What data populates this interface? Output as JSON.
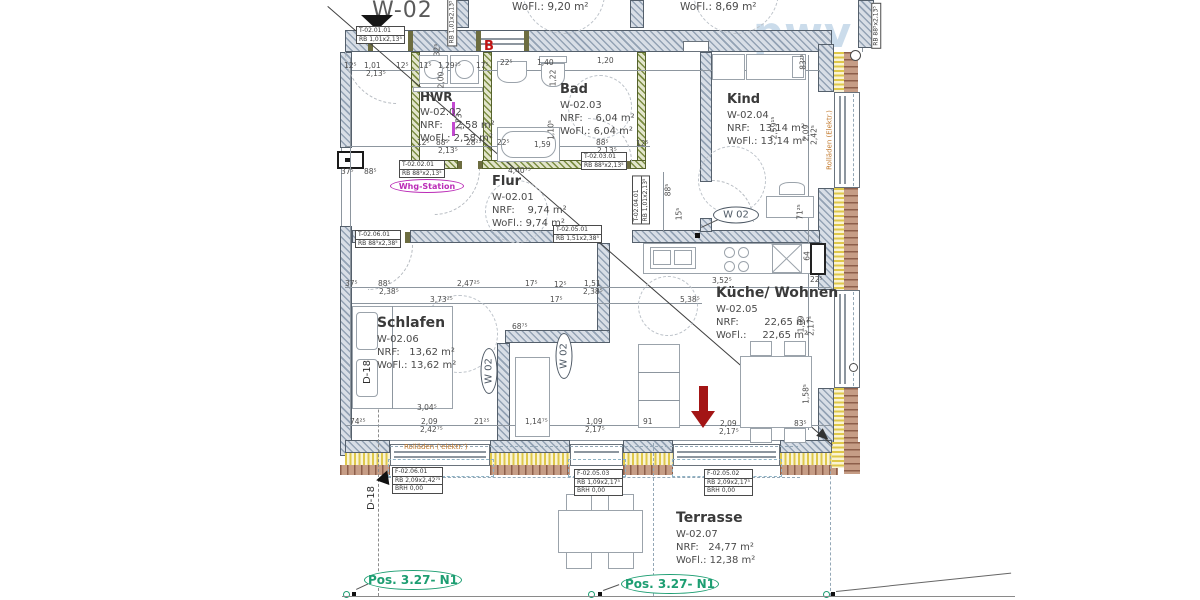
{
  "plan_title": "W-02",
  "watermark": "pwv",
  "colors": {
    "accent_green": "#1d9e72",
    "magenta": "#bb2cb7",
    "orange": "#c27a2e",
    "red_marker": "#a31515",
    "wall_green": "#7b8d42",
    "wall_gray": "#93a2b4",
    "brick": "#8d5f4b",
    "insulation": "#dfc84a",
    "watermark_blue": "#a9c6de"
  },
  "rooms": [
    {
      "title": "HWR",
      "code": "W-02.02",
      "nrf": "NRF:    2,58 m²",
      "wofl": "WoFl.: 2,58 m²",
      "x": 420,
      "y": 90,
      "fs": 12
    },
    {
      "title": "Bad",
      "code": "W-02.03",
      "nrf": "NRF:    6,04 m²",
      "wofl": "WoFl.: 6,04 m²",
      "x": 560,
      "y": 82,
      "fs": 13
    },
    {
      "title": "Kind",
      "code": "W-02.04",
      "nrf": "NRF:   13,14 m²",
      "wofl": "WoFl.: 13,14 m²",
      "x": 727,
      "y": 92,
      "fs": 13
    },
    {
      "title": "Flur",
      "code": "W-02.01",
      "nrf": "NRF:    9,74 m²",
      "wofl": "WoFl.: 9,74 m²",
      "x": 492,
      "y": 174,
      "fs": 13
    },
    {
      "title": "Küche/ Wohnen",
      "code": "W-02.05",
      "nrf": "NRF:        22,65 m²",
      "wofl": "WoFl.:     22,65 m²",
      "x": 716,
      "y": 285,
      "fs": 14
    },
    {
      "title": "Schlafen",
      "code": "W-02.06",
      "nrf": "NRF:   13,62 m²",
      "wofl": "WoFl.: 13,62 m²",
      "x": 377,
      "y": 315,
      "fs": 14
    },
    {
      "title": "Terrasse",
      "code": "W-02.07",
      "nrf": "NRF:   24,77 m²",
      "wofl": "WoFl.: 12,38 m²",
      "x": 676,
      "y": 510,
      "fs": 14
    }
  ],
  "ovals": [
    {
      "t": "W 02",
      "cx": 736,
      "cy": 215,
      "w": 46,
      "h": 17,
      "cls": "gray",
      "fs": 10
    },
    {
      "t": "W 02",
      "cx": 489,
      "cy": 371,
      "w": 46,
      "h": 17,
      "cls": "gray",
      "fs": 10,
      "vert": true
    },
    {
      "t": "W 02",
      "cx": 564,
      "cy": 356,
      "w": 46,
      "h": 17,
      "cls": "gray",
      "fs": 10,
      "vert": true
    },
    {
      "t": "Whg-Station",
      "cx": 427,
      "cy": 186,
      "w": 74,
      "h": 14,
      "cls": "magenta",
      "fs": 8
    },
    {
      "t": "Pos. 3.27- N1",
      "cx": 413,
      "cy": 580,
      "w": 98,
      "h": 20,
      "cls": "green",
      "fs": 12
    },
    {
      "t": "Pos. 3.27- N1",
      "cx": 670,
      "cy": 584,
      "w": 98,
      "h": 20,
      "cls": "green",
      "fs": 12
    }
  ],
  "ref_boxes": [
    {
      "x": 356,
      "y": 26,
      "lines": [
        "T-02.01.01",
        "RB 1,01x2,13⁵"
      ]
    },
    {
      "x": 399,
      "y": 160,
      "lines": [
        "T-02.02.01",
        "RB 88⁵x2,13⁵"
      ]
    },
    {
      "x": 581,
      "y": 152,
      "lines": [
        "T-02.03.01",
        "RB 88⁵x2,13⁵"
      ]
    },
    {
      "x": 355,
      "y": 230,
      "lines": [
        "T-02.06.01",
        "RB 88⁵x2,38⁵"
      ]
    },
    {
      "x": 553,
      "y": 225,
      "lines": [
        "T-02.05.01",
        "RB 1,51x2,38⁵"
      ]
    },
    {
      "x": 392,
      "y": 467,
      "lines": [
        "F-02.06.01",
        "RB  2,09x2,42⁷⁵",
        "BRH 0,00"
      ]
    },
    {
      "x": 574,
      "y": 469,
      "lines": [
        "F-02.05.03",
        "RB  1,09x2,17⁵",
        "BRH 0,00"
      ]
    },
    {
      "x": 704,
      "y": 469,
      "lines": [
        "F-02.05.02",
        "RB  2,09x2,17⁵",
        "BRH 0,00"
      ]
    },
    {
      "x": 452,
      "y": 22,
      "lines": [
        "RB 1,01x2,13⁵"
      ],
      "vert": true
    },
    {
      "x": 641,
      "y": 200,
      "lines": [
        "T-02.04.01",
        "RB 1,01x2,13⁵"
      ],
      "vert": true
    },
    {
      "x": 876,
      "y": 26,
      "lines": [
        "RB 88⁵x2,13⁵"
      ],
      "vert": true
    }
  ],
  "floating": [
    {
      "t": "WoFl.: 9,20 m²",
      "x": 512,
      "y": 2,
      "cls": "partial"
    },
    {
      "t": "WoFl.: 8,69 m²",
      "x": 680,
      "y": 2,
      "cls": "partial"
    },
    {
      "t": "B",
      "x": 484,
      "y": 40,
      "cls": "redB"
    },
    {
      "t": "D-18",
      "x": 368,
      "y": 372,
      "cls": "d18",
      "rot": 1
    },
    {
      "t": "D-18",
      "x": 372,
      "y": 498,
      "cls": "d18",
      "rot": 1
    },
    {
      "t": "Rolläden ('elektr.')",
      "x": 404,
      "y": 444,
      "cls": "roll"
    },
    {
      "t": "Rolläden (Elektr.)",
      "x": 830,
      "y": 140,
      "cls": "roll",
      "rot": 1
    }
  ],
  "dim_labels": [
    {
      "t": "12⁵",
      "x": 344,
      "y": 62
    },
    {
      "t": "1,01",
      "x": 364,
      "y": 62
    },
    {
      "t": "2,13⁵",
      "x": 366,
      "y": 70
    },
    {
      "t": "12⁵",
      "x": 396,
      "y": 62
    },
    {
      "t": "11⁵",
      "x": 419,
      "y": 62
    },
    {
      "t": "1,29²⁵",
      "x": 438,
      "y": 62
    },
    {
      "t": "17⁵",
      "x": 476,
      "y": 62
    },
    {
      "t": "22⁵",
      "x": 500,
      "y": 59
    },
    {
      "t": "1,40",
      "x": 537,
      "y": 59
    },
    {
      "t": "1,20",
      "x": 597,
      "y": 57
    },
    {
      "t": "32⁵",
      "x": 437,
      "y": 50,
      "rot": 1
    },
    {
      "t": "2,00",
      "x": 441,
      "y": 80,
      "rot": 1
    },
    {
      "t": "1,22",
      "x": 553,
      "y": 78,
      "rot": 1
    },
    {
      "t": "1,10⁵",
      "x": 551,
      "y": 130,
      "rot": 1
    },
    {
      "t": "83²⁵",
      "x": 803,
      "y": 62,
      "rot": 1
    },
    {
      "t": "2,59¹⁵",
      "x": 774,
      "y": 128,
      "rot": 1
    },
    {
      "t": "2,09",
      "x": 806,
      "y": 133,
      "rot": 1
    },
    {
      "t": "2,42⁵",
      "x": 814,
      "y": 135,
      "rot": 1
    },
    {
      "t": "12⁵",
      "x": 417,
      "y": 139
    },
    {
      "t": "88⁵",
      "x": 436,
      "y": 139
    },
    {
      "t": "2,13⁵",
      "x": 438,
      "y": 147
    },
    {
      "t": "28²⁵",
      "x": 466,
      "y": 139
    },
    {
      "t": "1,73",
      "x": 459,
      "y": 122,
      "rot": 1
    },
    {
      "t": "22⁵",
      "x": 497,
      "y": 139
    },
    {
      "t": "1,59",
      "x": 534,
      "y": 141
    },
    {
      "t": "88⁵",
      "x": 596,
      "y": 139
    },
    {
      "t": "2,13⁵",
      "x": 597,
      "y": 147
    },
    {
      "t": "12⁵",
      "x": 636,
      "y": 140
    },
    {
      "t": "37⁵",
      "x": 341,
      "y": 168
    },
    {
      "t": "88⁵",
      "x": 364,
      "y": 168
    },
    {
      "t": "4,40⁷⁵",
      "x": 508,
      "y": 167
    },
    {
      "t": "88⁵",
      "x": 668,
      "y": 190,
      "rot": 1
    },
    {
      "t": "15⁵",
      "x": 679,
      "y": 214,
      "rot": 1
    },
    {
      "t": "71²⁵",
      "x": 800,
      "y": 212,
      "rot": 1
    },
    {
      "t": "37⁵",
      "x": 345,
      "y": 280
    },
    {
      "t": "88⁵",
      "x": 378,
      "y": 280
    },
    {
      "t": "2,38⁵",
      "x": 379,
      "y": 288
    },
    {
      "t": "2,47²⁵",
      "x": 457,
      "y": 280
    },
    {
      "t": "17⁵",
      "x": 525,
      "y": 280
    },
    {
      "t": "12⁵",
      "x": 554,
      "y": 281
    },
    {
      "t": "1,51",
      "x": 584,
      "y": 280
    },
    {
      "t": "2,38⁵",
      "x": 583,
      "y": 288
    },
    {
      "t": "3,52⁵",
      "x": 712,
      "y": 277
    },
    {
      "t": "3,73²⁵",
      "x": 430,
      "y": 296
    },
    {
      "t": "17⁵",
      "x": 550,
      "y": 296
    },
    {
      "t": "5,38⁵",
      "x": 680,
      "y": 296
    },
    {
      "t": "64",
      "x": 807,
      "y": 256,
      "rot": 1
    },
    {
      "t": "22⁵",
      "x": 810,
      "y": 276
    },
    {
      "t": "68⁷⁵",
      "x": 512,
      "y": 323
    },
    {
      "t": "1,09",
      "x": 801,
      "y": 324,
      "rot": 1
    },
    {
      "t": "2,17⁵",
      "x": 811,
      "y": 326,
      "rot": 1
    },
    {
      "t": "1,58⁵",
      "x": 806,
      "y": 394,
      "rot": 1
    },
    {
      "t": "3,04⁵",
      "x": 417,
      "y": 404
    },
    {
      "t": "74²⁵",
      "x": 350,
      "y": 418
    },
    {
      "t": "2,09",
      "x": 421,
      "y": 418
    },
    {
      "t": "2,42⁷⁵",
      "x": 420,
      "y": 426
    },
    {
      "t": "21²⁵",
      "x": 474,
      "y": 418
    },
    {
      "t": "1,14⁷⁵",
      "x": 525,
      "y": 418
    },
    {
      "t": "1,09",
      "x": 586,
      "y": 418
    },
    {
      "t": "2,17⁵",
      "x": 585,
      "y": 426
    },
    {
      "t": "91",
      "x": 643,
      "y": 418
    },
    {
      "t": "2,09",
      "x": 720,
      "y": 420
    },
    {
      "t": "2,17⁵",
      "x": 719,
      "y": 428
    },
    {
      "t": "83⁵",
      "x": 794,
      "y": 420
    }
  ]
}
